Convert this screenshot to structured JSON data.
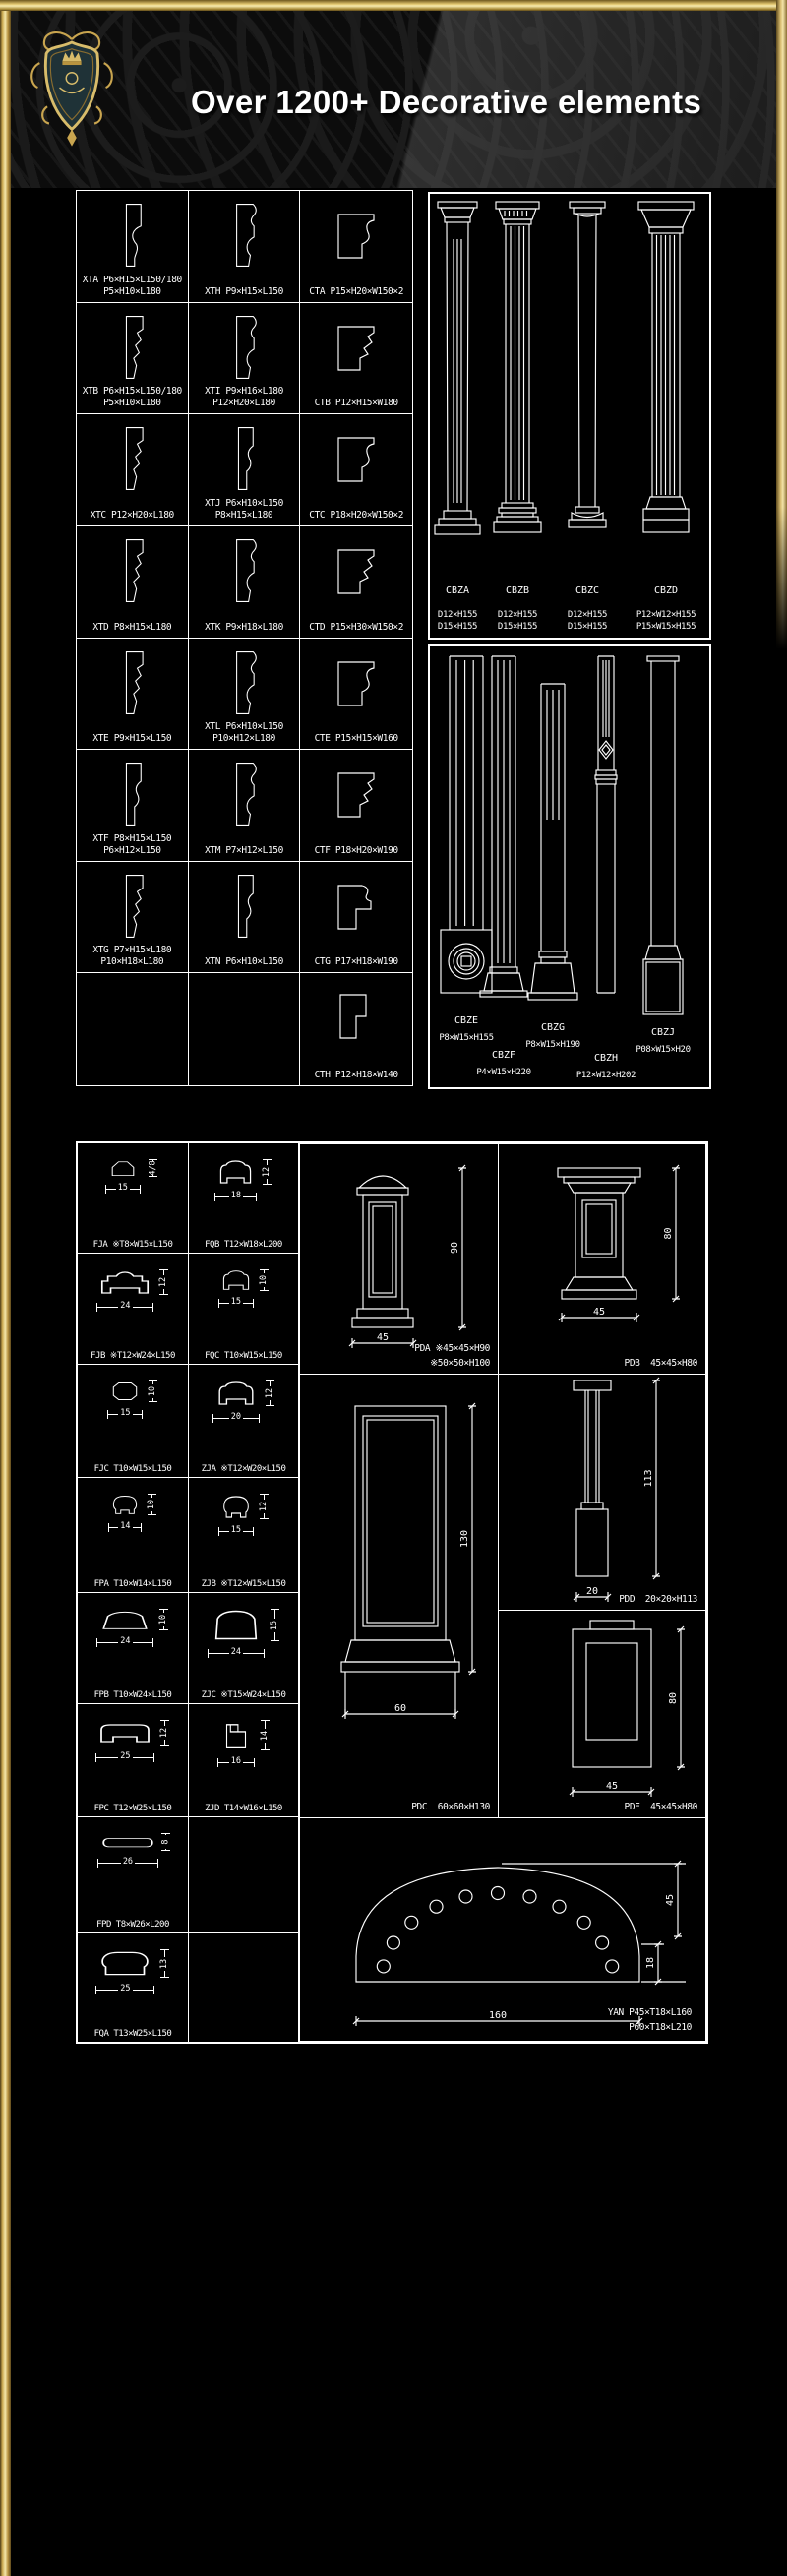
{
  "header": {
    "title": "Over 1200+ Decorative elements",
    "logo": "heraldic-crest-shield",
    "colors": {
      "gold": "#d8bc6a",
      "gold_light": "#f3e6a8",
      "gold_dark": "#7a5f2a",
      "background": "#000000",
      "line": "#ffffff",
      "shield_fill": "#1f3237"
    }
  },
  "panel1": {
    "moldings": {
      "rows": [
        [
          {
            "code": "XTA",
            "specs": [
              "P6×H15×L150/180",
              "P5×H10×L180"
            ],
            "shape": "xt-concave"
          },
          {
            "code": "XTH",
            "specs": [
              "P9×H15×L150"
            ],
            "shape": "xt-ogee"
          },
          {
            "code": "CTA",
            "specs": [
              "P15×H20×W150×2"
            ],
            "shape": "ct-curve"
          }
        ],
        [
          {
            "code": "XTB",
            "specs": [
              "P6×H15×L150/180",
              "P5×H10×L180"
            ],
            "shape": "xt-zigzag"
          },
          {
            "code": "XTI",
            "specs": [
              "P9×H16×L180",
              "P12×H20×L180"
            ],
            "shape": "xt-ogee"
          },
          {
            "code": "CTB",
            "specs": [
              "P12×H15×W180"
            ],
            "shape": "ct-step"
          }
        ],
        [
          {
            "code": "XTC",
            "specs": [
              "P12×H20×L180"
            ],
            "shape": "xt-zigzag"
          },
          {
            "code": "XTJ",
            "specs": [
              "P6×H10×L150",
              "P8×H15×L180"
            ],
            "shape": "xt-wave"
          },
          {
            "code": "CTC",
            "specs": [
              "P18×H20×W150×2"
            ],
            "shape": "ct-curve"
          }
        ],
        [
          {
            "code": "XTD",
            "specs": [
              "P8×H15×L180"
            ],
            "shape": "xt-zigzag"
          },
          {
            "code": "XTK",
            "specs": [
              "P9×H18×L180"
            ],
            "shape": "xt-ogee"
          },
          {
            "code": "CTD",
            "specs": [
              "P15×H30×W150×2"
            ],
            "shape": "ct-step"
          }
        ],
        [
          {
            "code": "XTE",
            "specs": [
              "P9×H15×L150"
            ],
            "shape": "xt-zigzag"
          },
          {
            "code": "XTL",
            "specs": [
              "P6×H10×L150",
              "P10×H12×L180"
            ],
            "shape": "xt-ogee"
          },
          {
            "code": "CTE",
            "specs": [
              "P15×H15×W160"
            ],
            "shape": "ct-curve"
          }
        ],
        [
          {
            "code": "XTF",
            "specs": [
              "P8×H15×L150",
              "P6×H12×L150"
            ],
            "shape": "xt-wave"
          },
          {
            "code": "XTM",
            "specs": [
              "P7×H12×L150"
            ],
            "shape": "xt-ogee"
          },
          {
            "code": "CTF",
            "specs": [
              "P18×H20×W190"
            ],
            "shape": "ct-step"
          }
        ],
        [
          {
            "code": "XTG",
            "specs": [
              "P7×H15×L180",
              "P10×H18×L180"
            ],
            "shape": "xt-zigzag"
          },
          {
            "code": "XTN",
            "specs": [
              "P6×H10×L150"
            ],
            "shape": "xt-wave"
          },
          {
            "code": "CTG",
            "specs": [
              "P17×H18×W190"
            ],
            "shape": "ct-bulge"
          }
        ],
        [
          null,
          null,
          {
            "code": "CTH",
            "specs": [
              "P12×H18×W140"
            ],
            "shape": "ct-plain"
          }
        ]
      ]
    },
    "columns_a": {
      "items": [
        {
          "code": "CBZA",
          "specs": [
            "D12×H155",
            "D15×H155"
          ],
          "style": "doric-fluted"
        },
        {
          "code": "CBZB",
          "specs": [
            "D12×H155",
            "D15×H155"
          ],
          "style": "dentil-fluted"
        },
        {
          "code": "CBZC",
          "specs": [
            "D12×H155",
            "D15×H155"
          ],
          "style": "tuscan-plain"
        },
        {
          "code": "CBZD",
          "specs": [
            "P12×W12×H155",
            "P15×W15×H155"
          ],
          "style": "flared-fluted"
        }
      ]
    },
    "columns_b": {
      "items": [
        {
          "code": "CBZE",
          "specs": [
            "P8×W15×H155"
          ],
          "style": "pilaster-rosette"
        },
        {
          "code": "CBZF",
          "specs": [
            "P4×W15×H220"
          ],
          "style": "fluted-step-base"
        },
        {
          "code": "CBZG",
          "specs": [
            "P8×W15×H190"
          ],
          "style": "molded-base"
        },
        {
          "code": "CBZH",
          "specs": [
            "P12×W12×H202"
          ],
          "style": "banded-slender"
        },
        {
          "code": "CBZJ",
          "specs": [
            "P08×W15×H20"
          ],
          "style": "plain-pedestal"
        }
      ]
    }
  },
  "panel2": {
    "profiles": {
      "rows": [
        [
          {
            "code": "FJA",
            "spec": "※T8×W15×L150",
            "shape": "p-peak",
            "w": "15",
            "h": "8",
            "h2": "4"
          },
          {
            "code": "FQB",
            "spec": "T12×W18×L200",
            "shape": "p-rail-notch",
            "w": "18",
            "h": "12"
          }
        ],
        [
          {
            "code": "FJB",
            "spec": "※T12×W24×L150",
            "shape": "p-rail-wide",
            "w": "24",
            "h": "12"
          },
          {
            "code": "FQC",
            "spec": "T10×W15×L150",
            "shape": "p-rail-notch",
            "w": "15",
            "h": "10"
          }
        ],
        [
          {
            "code": "FJC",
            "spec": "T10×W15×L150",
            "shape": "p-octagon",
            "w": "15",
            "h": "10"
          },
          {
            "code": "ZJA",
            "spec": "※T12×W20×L150",
            "shape": "p-rail-notch",
            "w": "20",
            "h": "12"
          }
        ],
        [
          {
            "code": "FPA",
            "spec": "T10×W14×L150",
            "shape": "p-mushroom",
            "w": "14",
            "h": "10"
          },
          {
            "code": "ZJB",
            "spec": "※T12×W15×L150",
            "shape": "p-mushroom",
            "w": "15",
            "h": "12"
          }
        ],
        [
          {
            "code": "FPB",
            "spec": "T10×W24×L150",
            "shape": "p-dome",
            "w": "24",
            "h": "10"
          },
          {
            "code": "ZJC",
            "spec": "※T15×W24×L150",
            "shape": "p-dome-tall",
            "w": "24",
            "h": "15"
          }
        ],
        [
          {
            "code": "FPC",
            "spec": "T12×W25×L150",
            "shape": "p-rail-flat",
            "w": "25",
            "h": "12"
          },
          {
            "code": "ZJD",
            "spec": "T14×W16×L150",
            "shape": "p-step-notch",
            "w": "16",
            "h": "14"
          }
        ],
        [
          {
            "code": "FPD",
            "spec": "T8×W26×L200",
            "shape": "p-round-rect",
            "w": "26",
            "h": "8"
          },
          null
        ],
        [
          {
            "code": "FQA",
            "spec": "T13×W25×L150",
            "shape": "p-dome-round",
            "w": "25",
            "h": "13"
          },
          null
        ]
      ]
    },
    "pedestals": [
      {
        "id": "PDA",
        "code": "PDA",
        "specs": [
          "※45×45×H90",
          "※50×50×H100"
        ],
        "w_dim": "45",
        "h_dim": "90"
      },
      {
        "id": "PDB",
        "code": "PDB",
        "specs": [
          "45×45×H80"
        ],
        "w_dim": "45",
        "h_dim": "80"
      },
      {
        "id": "PDD",
        "code": "PDD",
        "specs": [
          "20×20×H113"
        ],
        "w_dim": "20",
        "h_dim": "113"
      },
      {
        "id": "PDC",
        "code": "PDC",
        "specs": [
          "60×60×H130"
        ],
        "w_dim": "60",
        "h_dim": "130"
      },
      {
        "id": "PDE",
        "code": "PDE",
        "specs": [
          "45×45×H80"
        ],
        "w_dim": "45",
        "h_dim": "80"
      }
    ],
    "arch": {
      "code": "YAN",
      "specs": [
        "YAN P45×T18×L160",
        "P60×T18×L210"
      ],
      "w_dim": "160",
      "h_dim_upper": "45",
      "h_dim_lower": "18",
      "holes": 11
    }
  }
}
